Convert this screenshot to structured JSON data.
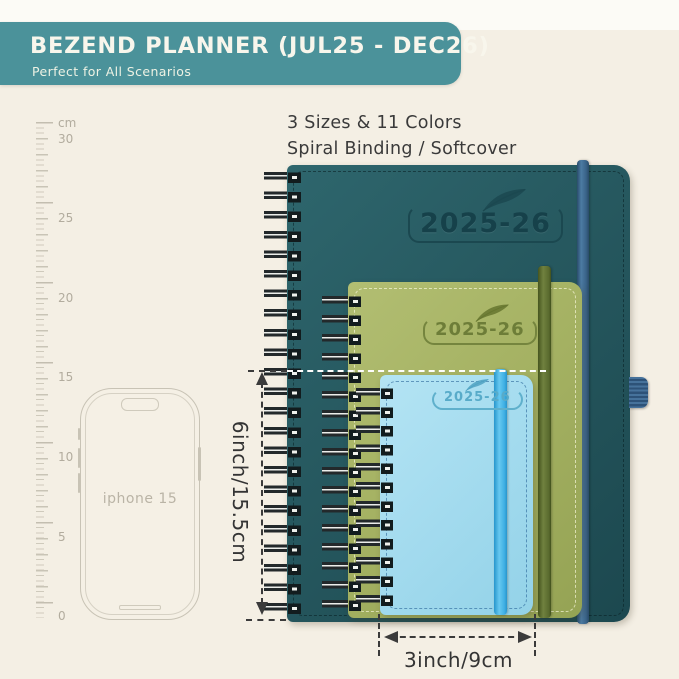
{
  "header": {
    "title": "BEZEND PLANNER (JUL25 - DEC26)",
    "subtitle": "Perfect for All Scenarios",
    "banner_color": "#4b929a"
  },
  "info": {
    "line1": "3 Sizes & 11 Colors",
    "line2": "Spiral Binding / Softcover"
  },
  "ruler": {
    "unit": "cm",
    "labels": [
      "30",
      "25",
      "20",
      "15",
      "10",
      "5",
      "0"
    ]
  },
  "phone": {
    "label": "iphone 15"
  },
  "planners": {
    "large": {
      "year": "2025-26",
      "icon": "feather-icon",
      "cover_color": "#26585f",
      "band_color": "#3a6489"
    },
    "medium": {
      "year": "2025-26",
      "icon": "feather-icon",
      "cover_color": "#a5b263",
      "band_color": "#596a2e"
    },
    "small": {
      "year": "2025-26",
      "icon": "feather-icon",
      "cover_color": "#a5dcef",
      "band_color": "#3fb0e4"
    }
  },
  "dimensions": {
    "height": "6inch/15.5cm",
    "width": "3inch/9cm"
  },
  "colors": {
    "background": "#f4efe4",
    "annotation_text": "#3b3b3b",
    "ruler": "#c9c4b6"
  }
}
